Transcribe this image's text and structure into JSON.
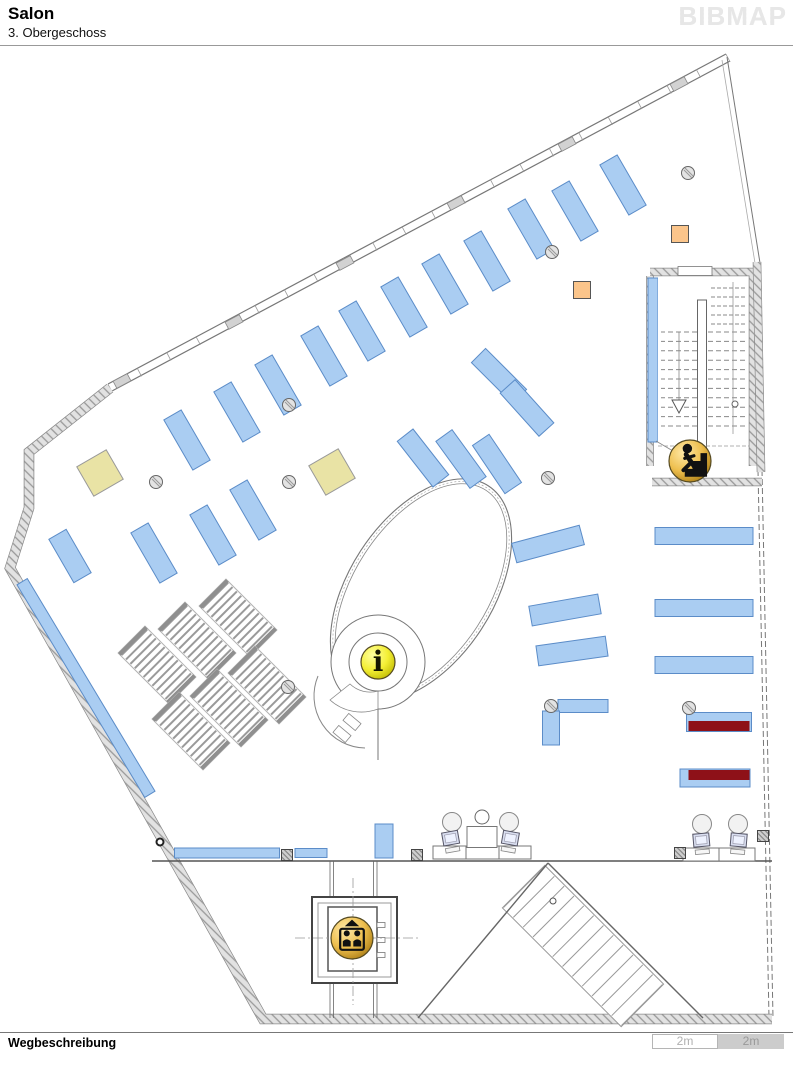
{
  "header": {
    "title": "Salon",
    "subtitle": "3. Obergeschoss",
    "logo": "BIBMAP"
  },
  "footer": {
    "label": "Wegbeschreibung",
    "scale_left": "2m",
    "scale_right": "2m"
  },
  "icons": {
    "info_glyph": "i"
  },
  "colors": {
    "shelf": "#aacdf2",
    "shelf_border": "#5b8cc8",
    "maroon": "#8e1118",
    "khaki": "#e9e3a5",
    "orange": "#fbc58b",
    "gold_hi": "#ffe9a8",
    "gold_mid": "#eebf4e",
    "gold_lo": "#a87a12",
    "yellow_hi": "#ffffa0",
    "yellow_mid": "#f4ef35",
    "yellow_lo": "#bdb800"
  },
  "map": {
    "features": [
      {
        "t": "line",
        "x1": 108,
        "y1": 384,
        "x2": 726,
        "y2": 54,
        "w": 1.2,
        "c": "#777"
      },
      {
        "t": "line",
        "x1": 112,
        "y1": 391,
        "x2": 730,
        "y2": 61,
        "w": 1.2,
        "c": "#777"
      },
      {
        "t": "treads",
        "x1": 110,
        "y1": 388,
        "x2": 728,
        "y2": 58,
        "n": 22,
        "len": 9,
        "c": "#999",
        "w": 0.8
      },
      {
        "t": "rect",
        "x": 122,
        "y": 381,
        "w": 16,
        "h": 8,
        "rot": -28,
        "f": "#d2d2d2",
        "s": "#888",
        "sw": 0.8
      },
      {
        "t": "rect",
        "x": 234,
        "y": 322,
        "w": 16,
        "h": 8,
        "rot": -28,
        "f": "#d2d2d2",
        "s": "#888",
        "sw": 0.8
      },
      {
        "t": "rect",
        "x": 345,
        "y": 263,
        "w": 16,
        "h": 8,
        "rot": -28,
        "f": "#d2d2d2",
        "s": "#888",
        "sw": 0.8
      },
      {
        "t": "rect",
        "x": 456,
        "y": 203,
        "w": 16,
        "h": 8,
        "rot": -28,
        "f": "#d2d2d2",
        "s": "#888",
        "sw": 0.8
      },
      {
        "t": "rect",
        "x": 567,
        "y": 144,
        "w": 16,
        "h": 8,
        "rot": -28,
        "f": "#d2d2d2",
        "s": "#888",
        "sw": 0.8
      },
      {
        "t": "rect",
        "x": 679,
        "y": 84,
        "w": 16,
        "h": 8,
        "rot": -28,
        "f": "#d2d2d2",
        "s": "#888",
        "sw": 0.8
      },
      {
        "t": "line",
        "x1": 727,
        "y1": 57,
        "x2": 760,
        "y2": 263,
        "w": 1,
        "c": "#777"
      },
      {
        "t": "line",
        "x1": 722,
        "y1": 60,
        "x2": 755,
        "y2": 263,
        "w": 0.8,
        "c": "#aaa"
      },
      {
        "t": "line",
        "x1": 758,
        "y1": 470,
        "x2": 769,
        "y2": 1018,
        "w": 1,
        "c": "#777",
        "dash": "6,3"
      },
      {
        "t": "line",
        "x1": 762,
        "y1": 470,
        "x2": 773,
        "y2": 1018,
        "w": 1,
        "c": "#777",
        "dash": "6,3"
      },
      {
        "t": "wall",
        "d": "M110,388 L29,452 L29,508 L10,568 L263,1019 L772,1019",
        "w": 9
      },
      {
        "t": "wall",
        "d": "M650,272 L753,272 L753,466",
        "w": 7
      },
      {
        "t": "wall",
        "d": "M650,276 L650,466",
        "w": 6
      },
      {
        "t": "wall",
        "d": "M652,482 L762,482",
        "w": 7
      },
      {
        "t": "wall",
        "d": "M757,262 L761,472",
        "w": 7
      },
      {
        "t": "line",
        "x1": 152,
        "y1": 861,
        "x2": 772,
        "y2": 861,
        "w": 1.6,
        "c": "#555"
      },
      {
        "t": "line",
        "x1": 330,
        "y1": 861,
        "x2": 330,
        "y2": 1018,
        "w": 0.8,
        "c": "#666"
      },
      {
        "t": "line",
        "x1": 333.5,
        "y1": 861,
        "x2": 333.5,
        "y2": 1018,
        "w": 0.8,
        "c": "#666"
      },
      {
        "t": "line",
        "x1": 373.5,
        "y1": 861,
        "x2": 373.5,
        "y2": 1018,
        "w": 0.8,
        "c": "#666"
      },
      {
        "t": "line",
        "x1": 377,
        "y1": 861,
        "x2": 377,
        "y2": 1018,
        "w": 0.8,
        "c": "#666"
      },
      {
        "t": "rect",
        "x": 583,
        "y": 946,
        "w": 168,
        "h": 60,
        "rot": 45,
        "f": "#fff",
        "s": "#999",
        "sw": 1
      },
      {
        "t": "treads",
        "x1": 524,
        "y1": 887,
        "x2": 642,
        "y2": 1005,
        "n": 13,
        "len": 58,
        "c": "#999",
        "w": 1
      },
      {
        "t": "line",
        "x1": 548,
        "y1": 863,
        "x2": 418,
        "y2": 1018,
        "w": 1.4,
        "c": "#666"
      },
      {
        "t": "line",
        "x1": 548,
        "y1": 863,
        "x2": 703,
        "y2": 1018,
        "w": 1.4,
        "c": "#666"
      },
      {
        "t": "circle",
        "cx": 553,
        "cy": 901,
        "r": 3,
        "f": "#fff",
        "c": "#555",
        "w": 1
      },
      {
        "t": "ellipse",
        "cx": 421,
        "cy": 590,
        "rx": 72,
        "ry": 124,
        "rot": 33,
        "c": "#777",
        "w": 1.1
      },
      {
        "t": "ellipse",
        "cx": 421,
        "cy": 590,
        "rx": 67,
        "ry": 119,
        "rot": 33,
        "c": "#888",
        "w": 0.8
      },
      {
        "t": "ellipse",
        "cx": 421,
        "cy": 590,
        "rx": 69.5,
        "ry": 121.5,
        "rot": 33,
        "c": "#aaa",
        "w": 0.7,
        "dash": "2,2"
      },
      {
        "t": "circle",
        "cx": 378,
        "cy": 662,
        "r": 47,
        "f": "#fff",
        "c": "#777",
        "w": 1
      },
      {
        "t": "path",
        "d": "M318,676 A52,52 0 0 0 365,748",
        "c": "#888",
        "w": 1,
        "f": "none"
      },
      {
        "t": "path",
        "d": "M330,700 A47,47 0 0 0 378,709 L378,691 A29,29 0 0 1 350,684 Z",
        "c": "#888",
        "w": 0.8,
        "f": "#fff"
      },
      {
        "t": "circle",
        "cx": 378,
        "cy": 662,
        "r": 29,
        "f": "#fff",
        "c": "#777",
        "w": 1
      },
      {
        "t": "line",
        "x1": 378,
        "y1": 709,
        "x2": 378,
        "y2": 760,
        "w": 1,
        "c": "#777"
      },
      {
        "t": "rect",
        "x": 352,
        "y": 722,
        "w": 16,
        "h": 9,
        "rot": 40,
        "f": "#fff",
        "s": "#888",
        "sw": 0.8
      },
      {
        "t": "rect",
        "x": 342,
        "y": 734,
        "w": 16,
        "h": 9,
        "rot": 40,
        "f": "#fff",
        "s": "#888",
        "sw": 0.8
      },
      {
        "t": "ladder",
        "x": 157,
        "y": 665,
        "w": 38,
        "h": 72,
        "rot": -45
      },
      {
        "t": "ladder",
        "x": 197,
        "y": 641,
        "w": 38,
        "h": 72,
        "rot": -45
      },
      {
        "t": "ladder",
        "x": 238,
        "y": 618,
        "w": 38,
        "h": 72,
        "rot": -45
      },
      {
        "t": "ladder",
        "x": 191,
        "y": 731,
        "w": 38,
        "h": 72,
        "rot": -45
      },
      {
        "t": "ladder",
        "x": 229,
        "y": 708,
        "w": 38,
        "h": 72,
        "rot": -45
      },
      {
        "t": "ladder",
        "x": 267,
        "y": 685,
        "w": 38,
        "h": 72,
        "rot": -45
      },
      {
        "t": "shelf",
        "x": 154,
        "y": 553,
        "w": 20,
        "h": 58,
        "rot": -30
      },
      {
        "t": "shelf",
        "x": 213,
        "y": 535,
        "w": 20,
        "h": 58,
        "rot": -30
      },
      {
        "t": "shelf",
        "x": 253,
        "y": 510,
        "w": 20,
        "h": 58,
        "rot": -30
      },
      {
        "t": "shelf",
        "x": 187,
        "y": 440,
        "w": 20,
        "h": 58,
        "rot": -30
      },
      {
        "t": "shelf",
        "x": 237,
        "y": 412,
        "w": 20,
        "h": 58,
        "rot": -30
      },
      {
        "t": "shelf",
        "x": 278,
        "y": 385,
        "w": 20,
        "h": 58,
        "rot": -30
      },
      {
        "t": "shelf",
        "x": 324,
        "y": 356,
        "w": 20,
        "h": 58,
        "rot": -30
      },
      {
        "t": "shelf",
        "x": 362,
        "y": 331,
        "w": 20,
        "h": 58,
        "rot": -30
      },
      {
        "t": "shelf",
        "x": 404,
        "y": 307,
        "w": 20,
        "h": 58,
        "rot": -30
      },
      {
        "t": "shelf",
        "x": 445,
        "y": 284,
        "w": 20,
        "h": 58,
        "rot": -30
      },
      {
        "t": "shelf",
        "x": 487,
        "y": 261,
        "w": 20,
        "h": 58,
        "rot": -30
      },
      {
        "t": "shelf",
        "x": 531,
        "y": 229,
        "w": 20,
        "h": 58,
        "rot": -30
      },
      {
        "t": "shelf",
        "x": 575,
        "y": 211,
        "w": 20,
        "h": 58,
        "rot": -30
      },
      {
        "t": "shelf",
        "x": 623,
        "y": 185,
        "w": 20,
        "h": 58,
        "rot": -30
      },
      {
        "t": "shelf",
        "x": 70,
        "y": 556,
        "w": 20,
        "h": 50,
        "rot": -30
      },
      {
        "t": "shelf",
        "x": 499,
        "y": 376,
        "w": 20,
        "h": 58,
        "rot": -45
      },
      {
        "t": "shelf",
        "x": 527,
        "y": 408,
        "w": 20,
        "h": 58,
        "rot": -42
      },
      {
        "t": "shelf",
        "x": 423,
        "y": 458,
        "w": 20,
        "h": 58,
        "rot": -38
      },
      {
        "t": "shelf",
        "x": 461,
        "y": 459,
        "w": 20,
        "h": 58,
        "rot": -36
      },
      {
        "t": "shelf",
        "x": 497,
        "y": 464,
        "w": 20,
        "h": 58,
        "rot": -34
      },
      {
        "t": "shelf",
        "x": 548,
        "y": 544,
        "w": 70,
        "h": 20,
        "rot": -15
      },
      {
        "t": "shelf",
        "x": 565,
        "y": 610,
        "w": 70,
        "h": 20,
        "rot": -10
      },
      {
        "t": "shelf",
        "x": 572,
        "y": 651,
        "w": 70,
        "h": 20,
        "rot": -8
      },
      {
        "t": "shelf",
        "x": 704,
        "y": 536,
        "w": 98,
        "h": 17,
        "rot": 0
      },
      {
        "t": "shelf",
        "x": 704,
        "y": 608,
        "w": 98,
        "h": 17,
        "rot": 0
      },
      {
        "t": "shelf",
        "x": 704,
        "y": 665,
        "w": 98,
        "h": 17,
        "rot": 0
      },
      {
        "t": "shelf",
        "x": 719,
        "y": 722,
        "w": 65,
        "h": 19,
        "rot": 0
      },
      {
        "t": "shelf",
        "x": 715,
        "y": 778,
        "w": 70,
        "h": 18,
        "rot": 0
      },
      {
        "t": "shelf",
        "x": 653,
        "y": 360,
        "w": 10,
        "h": 164,
        "rot": 0
      },
      {
        "t": "shelf",
        "x": 227,
        "y": 853,
        "w": 105,
        "h": 10,
        "rot": 0
      },
      {
        "t": "shelf",
        "x": 311,
        "y": 853,
        "w": 32,
        "h": 9,
        "rot": 0
      },
      {
        "t": "shelf",
        "x": 384,
        "y": 841,
        "w": 18,
        "h": 34,
        "rot": 0
      },
      {
        "t": "shelf",
        "x": 583,
        "y": 706,
        "w": 50,
        "h": 13,
        "rot": 0
      },
      {
        "t": "shelf",
        "x": 551,
        "y": 728,
        "w": 17,
        "h": 34,
        "rot": 0
      },
      {
        "t": "shelf",
        "x": 86,
        "y": 688,
        "w": 12,
        "h": 248,
        "rot": -31
      },
      {
        "t": "rect",
        "x": 719,
        "y": 726,
        "w": 61,
        "h": 10,
        "rot": 0,
        "f": "#8e1118",
        "s": "none"
      },
      {
        "t": "rect",
        "x": 719,
        "y": 775,
        "w": 61,
        "h": 10,
        "rot": 0,
        "f": "#8e1118",
        "s": "none"
      },
      {
        "t": "rect",
        "x": 100,
        "y": 473,
        "w": 34,
        "h": 34,
        "rot": -30,
        "f": "#e9e3a5",
        "s": "#999",
        "sw": 1
      },
      {
        "t": "rect",
        "x": 332,
        "y": 472,
        "w": 34,
        "h": 34,
        "rot": -30,
        "f": "#e9e3a5",
        "s": "#999",
        "sw": 1
      },
      {
        "t": "rect",
        "x": 680,
        "y": 234,
        "w": 17,
        "h": 17,
        "rot": 0,
        "f": "#fbc58b",
        "s": "#555",
        "sw": 1
      },
      {
        "t": "rect",
        "x": 582,
        "y": 290,
        "w": 17,
        "h": 17,
        "rot": 0,
        "f": "#fbc58b",
        "s": "#555",
        "sw": 1
      },
      {
        "t": "rect",
        "x": 703,
        "y": 369,
        "w": 90,
        "h": 184,
        "rot": 0,
        "f": "#fff",
        "s": "none"
      },
      {
        "t": "treads",
        "x1": 703,
        "y1": 332,
        "x2": 703,
        "y2": 426,
        "n": 11,
        "len": 84,
        "c": "#888",
        "w": 1,
        "dash": "5,3"
      },
      {
        "t": "treads",
        "x1": 727,
        "y1": 288,
        "x2": 727,
        "y2": 324,
        "n": 5,
        "len": 36,
        "c": "#888",
        "w": 0.9,
        "dash": "4,2"
      },
      {
        "t": "rect",
        "x": 702,
        "y": 374,
        "w": 9,
        "h": 148,
        "rot": 0,
        "f": "#fff",
        "s": "#666",
        "sw": 1
      },
      {
        "t": "line",
        "x1": 733,
        "y1": 282,
        "x2": 733,
        "y2": 434,
        "w": 0.8,
        "c": "#999"
      },
      {
        "t": "line",
        "x1": 679,
        "y1": 332,
        "x2": 679,
        "y2": 400,
        "w": 0.8,
        "c": "#888"
      },
      {
        "t": "path",
        "d": "M672,400 L686,400 L679,413 Z",
        "f": "#fff",
        "c": "#555",
        "w": 1
      },
      {
        "t": "circle",
        "cx": 735,
        "cy": 404,
        "r": 3,
        "f": "#fff",
        "c": "#666",
        "w": 1
      },
      {
        "t": "line",
        "x1": 658,
        "y1": 446,
        "x2": 749,
        "y2": 446,
        "w": 0.8,
        "c": "#999",
        "dash": "4,2"
      },
      {
        "t": "rect",
        "x": 695,
        "y": 271,
        "w": 34,
        "h": 9,
        "rot": 0,
        "f": "#fff",
        "s": "#777",
        "sw": 0.8
      },
      {
        "t": "line",
        "x1": 690,
        "y1": 461,
        "x2": 656,
        "y2": 441,
        "w": 0.8,
        "c": "#888"
      },
      {
        "t": "rect",
        "x": 354.5,
        "y": 940,
        "w": 85,
        "h": 86,
        "rot": 0,
        "f": "#fff",
        "s": "#444",
        "sw": 2
      },
      {
        "t": "rect",
        "x": 354.5,
        "y": 940,
        "w": 73,
        "h": 74,
        "rot": 0,
        "f": "none",
        "s": "#999",
        "sw": 1
      },
      {
        "t": "rect",
        "x": 352.5,
        "y": 939,
        "w": 49,
        "h": 64,
        "rot": 0,
        "f": "#fff",
        "s": "#555",
        "sw": 1.5
      },
      {
        "t": "rect",
        "x": 381,
        "y": 925,
        "w": 8,
        "h": 5,
        "rot": 0,
        "f": "#fff",
        "s": "#777",
        "sw": 0.8
      },
      {
        "t": "rect",
        "x": 381,
        "y": 940,
        "w": 8,
        "h": 5,
        "rot": 0,
        "f": "#fff",
        "s": "#777",
        "sw": 0.8
      },
      {
        "t": "rect",
        "x": 381,
        "y": 955,
        "w": 8,
        "h": 5,
        "rot": 0,
        "f": "#fff",
        "s": "#777",
        "sw": 0.8
      },
      {
        "t": "line",
        "x1": 295,
        "y1": 938,
        "x2": 420,
        "y2": 938,
        "w": 0.8,
        "c": "#999",
        "dash": "10,3,2,3"
      },
      {
        "t": "line",
        "x1": 353,
        "y1": 878,
        "x2": 353,
        "y2": 1005,
        "w": 0.8,
        "c": "#999",
        "dash": "10,3,2,3"
      },
      {
        "t": "rect",
        "x": 449.5,
        "y": 852.5,
        "w": 33,
        "h": 13,
        "rot": 0,
        "f": "#fff",
        "s": "#777",
        "sw": 1
      },
      {
        "t": "rect",
        "x": 482.5,
        "y": 852.5,
        "w": 33,
        "h": 13,
        "rot": 0,
        "f": "#fff",
        "s": "#777",
        "sw": 1
      },
      {
        "t": "rect",
        "x": 515,
        "y": 852.5,
        "w": 32,
        "h": 13,
        "rot": 0,
        "f": "#fff",
        "s": "#777",
        "sw": 1
      },
      {
        "t": "rect",
        "x": 482,
        "y": 837,
        "w": 30,
        "h": 21,
        "rot": 0,
        "f": "#fff",
        "s": "#777",
        "sw": 1
      },
      {
        "t": "circle",
        "cx": 482,
        "cy": 817,
        "r": 7,
        "f": "#fff",
        "c": "#666",
        "w": 1
      },
      {
        "t": "comp",
        "cx": 452,
        "cy": 846,
        "rot": -10
      },
      {
        "t": "comp",
        "cx": 509,
        "cy": 846,
        "rot": 10
      },
      {
        "t": "rect",
        "x": 701,
        "y": 854.5,
        "w": 36,
        "h": 13,
        "rot": 0,
        "f": "#fff",
        "s": "#777",
        "sw": 1
      },
      {
        "t": "rect",
        "x": 737,
        "y": 854.5,
        "w": 36,
        "h": 13,
        "rot": 0,
        "f": "#fff",
        "s": "#777",
        "sw": 1
      },
      {
        "t": "comp",
        "cx": 702,
        "cy": 848,
        "rot": -5
      },
      {
        "t": "comp",
        "cx": 738,
        "cy": 848,
        "rot": 5
      },
      {
        "t": "col",
        "cx": 289,
        "cy": 405
      },
      {
        "t": "col",
        "cx": 156,
        "cy": 482
      },
      {
        "t": "col",
        "cx": 289,
        "cy": 482
      },
      {
        "t": "col",
        "cx": 552,
        "cy": 252
      },
      {
        "t": "col",
        "cx": 688,
        "cy": 173
      },
      {
        "t": "col",
        "cx": 548,
        "cy": 478
      },
      {
        "t": "col",
        "cx": 551,
        "cy": 706
      },
      {
        "t": "col",
        "cx": 689,
        "cy": 708
      },
      {
        "t": "col",
        "cx": 288,
        "cy": 687
      },
      {
        "t": "circle",
        "cx": 160,
        "cy": 842,
        "r": 3.5,
        "f": "#fff",
        "c": "#222",
        "w": 2
      },
      {
        "t": "hcol",
        "cx": 287,
        "cy": 855
      },
      {
        "t": "hcol",
        "cx": 417,
        "cy": 855
      },
      {
        "t": "hcol",
        "cx": 680,
        "cy": 853
      },
      {
        "t": "hcol",
        "cx": 763,
        "cy": 836
      },
      {
        "t": "marker",
        "kind": "stairs",
        "cx": 690,
        "cy": 461,
        "r": 21
      },
      {
        "t": "marker",
        "kind": "elevator",
        "cx": 352,
        "cy": 938,
        "r": 21
      },
      {
        "t": "marker",
        "kind": "info",
        "cx": 378,
        "cy": 662,
        "r": 17
      }
    ]
  }
}
